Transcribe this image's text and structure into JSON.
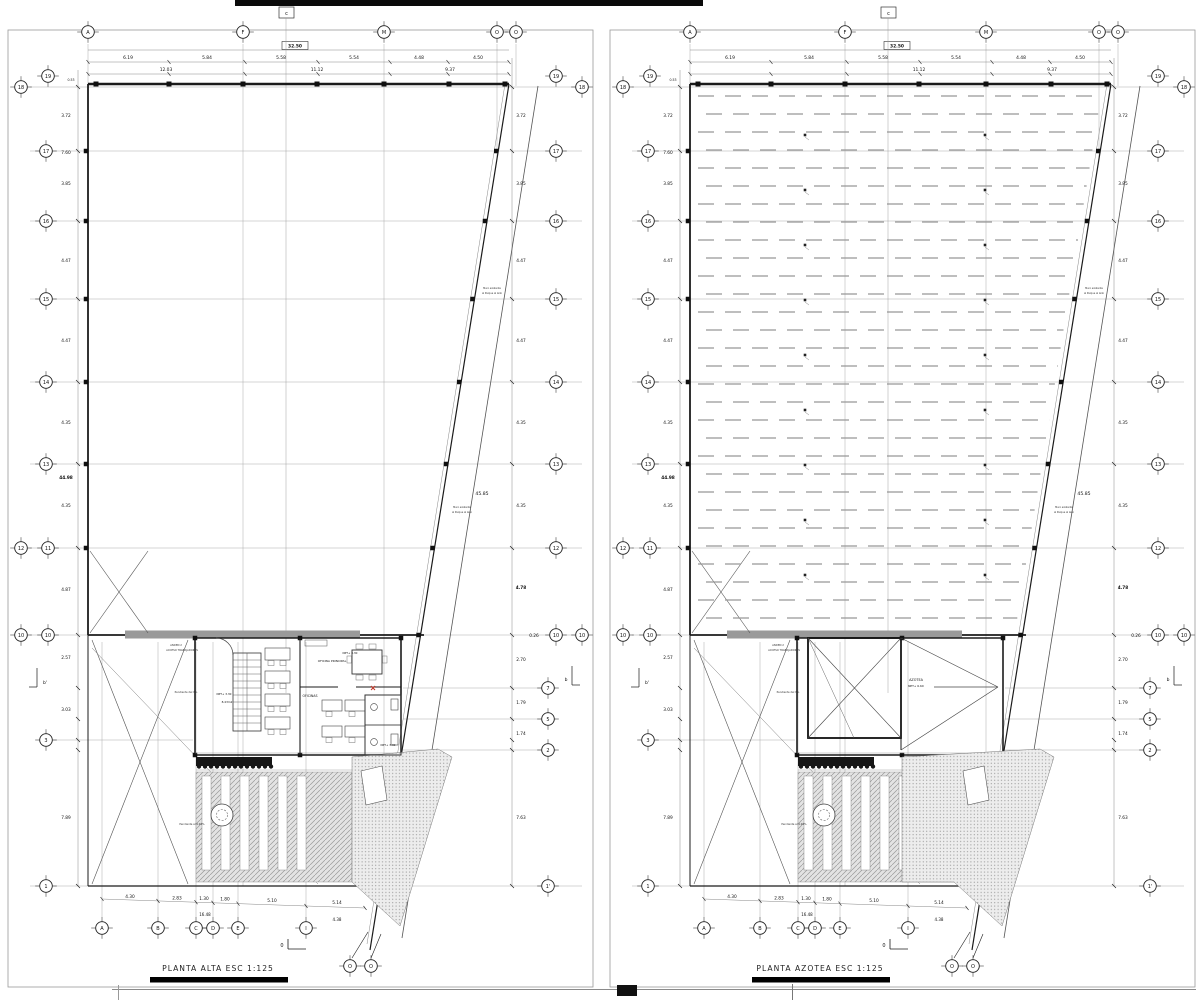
{
  "page": {
    "background": "#ffffff",
    "ink": "#1b1b1b",
    "medium": "#666666",
    "light": "#aaaaaa",
    "accent_red": "#c0392b"
  },
  "sheets": [
    {
      "id": "planta-alta",
      "title": "PLANTA ALTA",
      "scale": "ESC  1:125",
      "title_full": "PLANTA ALTA   ESC   1:125",
      "variant": "floor"
    },
    {
      "id": "planta-azotea",
      "title": "PLANTA AZOTEA",
      "scale": "ESC  1:125",
      "title_full": "PLANTA AZOTEA   ESC   1:125",
      "variant": "roof"
    }
  ],
  "grid": {
    "top_bubbles": [
      "A",
      "F",
      "M",
      "O",
      "O"
    ],
    "bottom_bubbles": [
      "A",
      "B",
      "C",
      "D",
      "E",
      "I"
    ],
    "bottom_o_bubbles": [
      "O",
      "O"
    ],
    "rows": [
      {
        "left": [
          "18",
          "19"
        ],
        "right": [
          "19",
          "18"
        ]
      },
      {
        "left": [
          "17"
        ],
        "right": [
          "17"
        ]
      },
      {
        "left": [
          "16"
        ],
        "right": [
          "16"
        ]
      },
      {
        "left": [
          "15"
        ],
        "right": [
          "15"
        ]
      },
      {
        "left": [
          "14"
        ],
        "right": [
          "14"
        ]
      },
      {
        "left": [
          "13"
        ],
        "right": [
          "13"
        ]
      },
      {
        "left": [
          "12",
          "11"
        ],
        "right": [
          "12"
        ]
      },
      {
        "left": [
          "10",
          "10"
        ],
        "right": [
          "10",
          "10"
        ]
      },
      {
        "left": [
          "3"
        ],
        "right": []
      },
      {
        "left": [],
        "right": [
          "7"
        ]
      },
      {
        "left": [],
        "right": [
          "5"
        ]
      },
      {
        "left": [],
        "right": [
          "2"
        ]
      },
      {
        "left": [
          "1"
        ],
        "right": [
          "1'"
        ]
      }
    ]
  },
  "markers": {
    "section_c": "c",
    "section_b": "b",
    "section_b_prime": "b'",
    "section_zero": "0"
  },
  "dims": {
    "top_total": "32.50",
    "top_row1": [
      "6.19",
      "5.84",
      "5.58",
      "5.54",
      "4.48",
      "4.50"
    ],
    "top_row2": [
      "12.03",
      "11.12",
      "9.37"
    ],
    "top_left_small": "0.53",
    "left": [
      {
        "t": "3.72",
        "y": 117
      },
      {
        "t": "7.60",
        "y": 154
      },
      {
        "t": "3.85",
        "y": 185
      },
      {
        "t": "4.47",
        "y": 262
      },
      {
        "t": "4.47",
        "y": 342
      },
      {
        "t": "4.35",
        "y": 424
      },
      {
        "t": "44.98",
        "y": 479,
        "b": 1
      },
      {
        "t": "4.35",
        "y": 507
      },
      {
        "t": "4.87",
        "y": 591
      },
      {
        "t": "2.57",
        "y": 659
      },
      {
        "t": "3.03",
        "y": 711
      },
      {
        "t": "7.89",
        "y": 819
      }
    ],
    "right": [
      {
        "t": "3.72",
        "y": 117
      },
      {
        "t": "3.85",
        "y": 185
      },
      {
        "t": "4.47",
        "y": 262
      },
      {
        "t": "4.47",
        "y": 342
      },
      {
        "t": "4.35",
        "y": 424
      },
      {
        "t": "4.35",
        "y": 507
      },
      {
        "t": "4.78",
        "y": 589,
        "b": 1
      },
      {
        "t": "0.26",
        "y": 637,
        "x": 534
      },
      {
        "t": "2.70",
        "y": 661
      },
      {
        "t": "1.79",
        "y": 704
      },
      {
        "t": "1.74",
        "y": 735
      },
      {
        "t": "7.63",
        "y": 819
      }
    ],
    "slant_dim": "45.85",
    "bottom": [
      "4.30",
      "2.83",
      "1.30",
      "1.80",
      "5.10",
      "5.14"
    ],
    "bottom_extra": [
      {
        "t": "16.48",
        "x": 205,
        "y": 916
      },
      {
        "t": "4.38",
        "x": 337,
        "y": 921
      }
    ]
  },
  "annotations": {
    "floor": [
      {
        "t": "NPT+ 3.30",
        "x": 350,
        "y": 654,
        "s": 2.8
      },
      {
        "t": "OFICINA PRINCIPAL",
        "x": 332,
        "y": 662,
        "s": 3.0
      },
      {
        "t": "OFICINAS",
        "x": 310,
        "y": 697,
        "s": 3.2
      },
      {
        "t": "NPT+ 3.30",
        "x": 224,
        "y": 695,
        "s": 2.8
      },
      {
        "t": "8.43m2",
        "x": 227,
        "y": 703,
        "s": 2.8
      },
      {
        "t": "NPT+ 3.30",
        "x": 388,
        "y": 746,
        "s": 2.8
      }
    ],
    "roof": [
      {
        "t": "AZOTEA",
        "x": 314,
        "y": 681,
        "s": 3.4
      },
      {
        "t": "NPT+ 6.60",
        "x": 314,
        "y": 687,
        "s": 2.9
      }
    ],
    "shared": [
      {
        "t": "ANDEN 2",
        "x": 176,
        "y": 646,
        "s": 2.6
      },
      {
        "t": "ACCESO TRABAJADORES",
        "x": 182,
        "y": 651,
        "s": 2.6
      },
      {
        "t": "Pendiente del 6%",
        "x": 186,
        "y": 693,
        "s": 2.6
      },
      {
        "t": "Pendiente al 4.91%",
        "x": 192,
        "y": 825,
        "s": 2.6
      },
      {
        "t": "Muro existente",
        "x": 492,
        "y": 289,
        "s": 2.4
      },
      {
        "t": "al Parque al lado",
        "x": 492,
        "y": 294,
        "s": 2.4
      },
      {
        "t": "Muro existente",
        "x": 462,
        "y": 508,
        "s": 2.4
      },
      {
        "t": "al Parque al lado",
        "x": 462,
        "y": 513,
        "s": 2.4
      }
    ]
  }
}
